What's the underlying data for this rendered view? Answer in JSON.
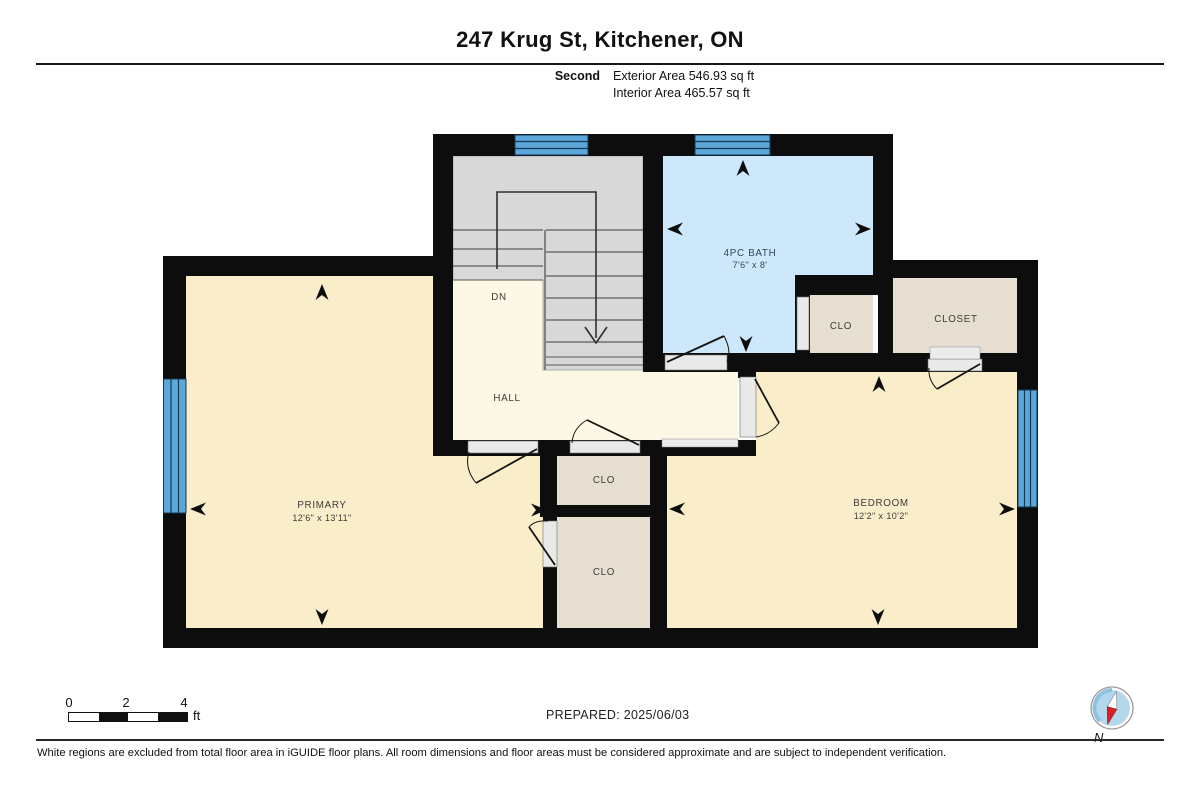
{
  "header": {
    "title": "247 Krug St, Kitchener, ON",
    "floor_label": "Second",
    "exterior_area": "Exterior Area 546.93 sq ft",
    "interior_area": "Interior Area 465.57 sq ft"
  },
  "plan": {
    "rooms": {
      "primary": {
        "name": "PRIMARY",
        "dims": "12'6\" x 13'11\""
      },
      "bedroom": {
        "name": "BEDROOM",
        "dims": "12'2\" x 10'2\""
      },
      "bath": {
        "name": "4PC BATH",
        "dims": "7'6\" x 8'"
      },
      "hall": {
        "name": "HALL"
      },
      "closet": {
        "name": "CLOSET"
      },
      "clo_bath": {
        "name": "CLO"
      },
      "clo_hall": {
        "name": "CLO"
      },
      "clo_primary": {
        "name": "CLO"
      },
      "stairs": {
        "label": "DN"
      }
    }
  },
  "scale_bar": {
    "ticks": [
      "0",
      "2",
      "4"
    ],
    "unit": "ft"
  },
  "compass": {
    "label": "N"
  },
  "footer": {
    "prepared": "PREPARED: 2025/06/03",
    "disclaimer": "White regions are excluded from total floor area in iGUIDE floor plans. All room dimensions and floor areas must be considered approximate and are subject to independent verification."
  },
  "colors": {
    "wall": "#0d0d0d",
    "room_fill": "#faeeca",
    "hall_fill": "#fdf8e6",
    "bath_fill": "#cde8fa",
    "closet_fill": "#e6dfd1",
    "stair_fill": "#d8d8d8",
    "window_fill": "#5ba7d9"
  }
}
